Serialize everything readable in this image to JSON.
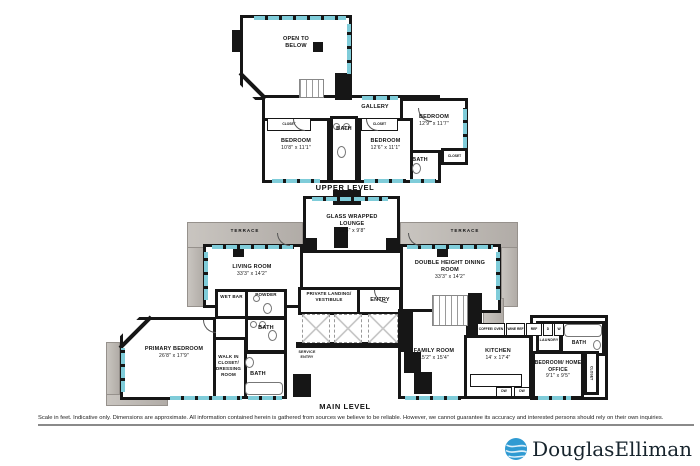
{
  "colors": {
    "wall": "#161616",
    "window": "#7fccd9",
    "terrace": "#b8b3ae",
    "logo_blue": "#2f9ad2",
    "ink": "#141414"
  },
  "upper": {
    "title": "UPPER LEVEL",
    "open_to_below": "OPEN TO BELOW",
    "gallery": "GALLERY",
    "bedroom_a": {
      "name": "BEDROOM",
      "dims": "10'8\" x 11'1\""
    },
    "bedroom_b": {
      "name": "BEDROOM",
      "dims": "12'6\" x 11'1\""
    },
    "bedroom_c": {
      "name": "BEDROOM",
      "dims": "12'9\" x 11'7\""
    },
    "bath": "BATH",
    "closet": "CLOSET"
  },
  "main": {
    "title": "MAIN LEVEL",
    "terrace": "TERRACE",
    "lounge": {
      "name": "GLASS WRAPPED LOUNGE",
      "dims": "18'6\" x 9'8\""
    },
    "living": {
      "name": "LIVING ROOM",
      "dims": "33'3\" x 14'2\""
    },
    "dining": {
      "name": "DOUBLE HEIGHT DINING ROOM",
      "dims": "33'3\" x 14'2\""
    },
    "landing": "PRIVATE LANDING/ VESTIBULE",
    "entry": "ENTRY",
    "wet_bar": "WET BAR",
    "powder": "POWDER",
    "bath": "BATH",
    "service_entry": "SERVICE ENTRY",
    "walk_in": "WALK IN CLOSET/ DRESSING ROOM",
    "primary": {
      "name": "PRIMARY BEDROOM",
      "dims": "26'8\" x 17'9\""
    },
    "family": {
      "name": "FAMILY ROOM",
      "dims": "15'2\" x 15'4\""
    },
    "kitchen": {
      "name": "KITCHEN",
      "dims": "14' x 17'4\""
    },
    "office": {
      "name": "BEDROOM/ HOME OFFICE",
      "dims": "9'1\" x 9'5\""
    },
    "laundry": "LAUNDRY",
    "closet": "CLOSET",
    "appliances": {
      "oven": "COFFEE/ OVEN",
      "wine": "WINE REF",
      "ref": "REF",
      "d": "D",
      "w": "W",
      "dw": "DW"
    }
  },
  "footer": {
    "disclaimer": "Scale in feet. Indicative only. Dimensions are approximate. All information contained herein is gathered from sources we believe to be reliable. However, we cannot guarantee its accuracy and interested persons should rely on their own inquiries.",
    "logo_text": "DouglasElliman"
  }
}
